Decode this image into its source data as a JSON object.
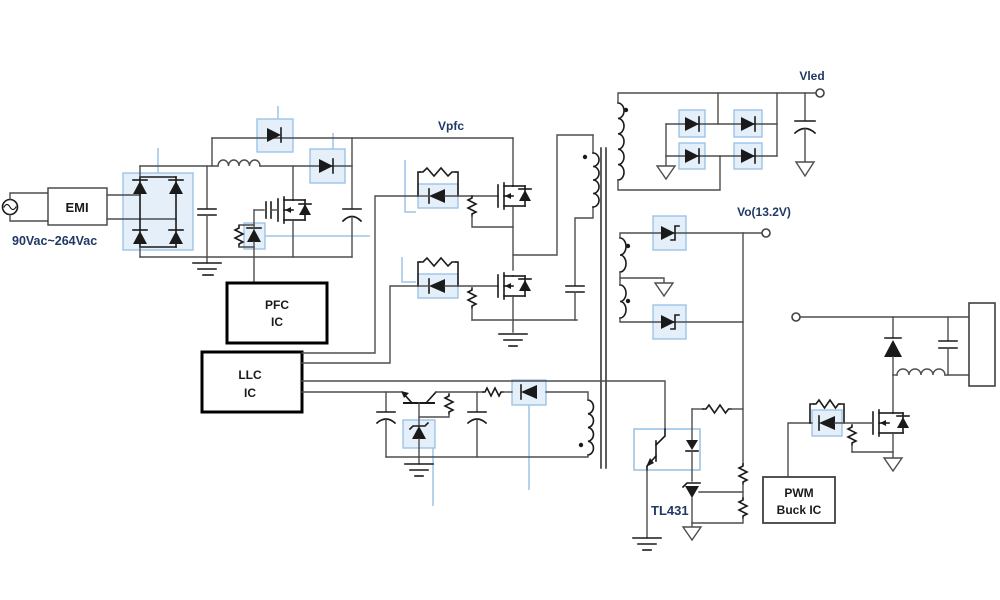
{
  "diagram": {
    "labels": {
      "input_range": "90Vac~264Vac",
      "emi": "EMI",
      "vpfc": "Vpfc",
      "vled": "Vled",
      "vo": "Vo(13.2V)",
      "tl431": "TL431",
      "pfc_ic": [
        "PFC",
        "IC"
      ],
      "llc_ic": [
        "LLC",
        "IC"
      ],
      "pwm_buck_ic": [
        "PWM",
        "Buck IC"
      ]
    },
    "colors": {
      "background": "#ffffff",
      "wire": "#4d4d4d",
      "component": "#1a1a1a",
      "highlight_fill": "#dce9f8",
      "highlight_border": "#9dc3e6",
      "leader_line": "#9dc3e6",
      "label_blue": "#1f3864",
      "label_black": "#1a1a1a"
    }
  }
}
